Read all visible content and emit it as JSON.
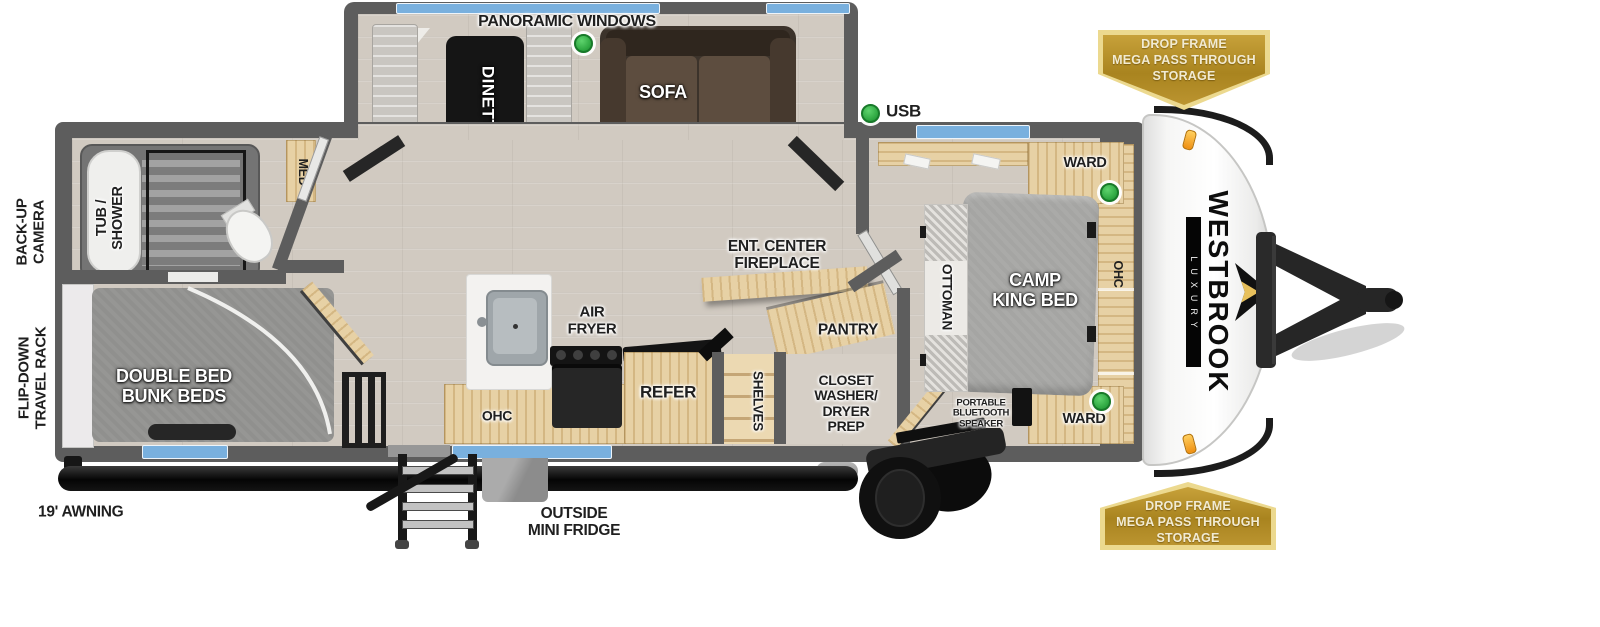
{
  "brand": {
    "name": "WESTBROOK",
    "tagline": "LUXURY"
  },
  "exterior": {
    "awning": "19' AWNING",
    "outside_fridge_line1": "OUTSIDE",
    "outside_fridge_line2": "MINI FRIDGE",
    "back_up_camera_line1": "BACK-UP",
    "back_up_camera_line2": "CAMERA",
    "travel_rack_line1": "FLIP-DOWN",
    "travel_rack_line2": "TRAVEL RACK",
    "badge_top": {
      "line1": "DROP FRAME",
      "line2": "MEGA PASS THROUGH",
      "line3": "STORAGE"
    },
    "badge_bottom": {
      "line1": "DROP FRAME",
      "line2": "MEGA PASS THROUGH",
      "line3": "STORAGE"
    }
  },
  "living_area": {
    "panoramic_windows": "PANORAMIC WINDOWS",
    "dinette": "DINETTE",
    "sofa": "SOFA",
    "usb": "USB",
    "ent_center_line1": "ENT. CENTER",
    "ent_center_line2": "FIREPLACE",
    "pantry": "PANTRY",
    "shelves": "SHELVES",
    "closet_line1": "CLOSET",
    "closet_line2": "WASHER/",
    "closet_line3": "DRYER",
    "closet_line4": "PREP"
  },
  "kitchen": {
    "air_fryer_line1": "AIR",
    "air_fryer_line2": "FRYER",
    "ohc": "OHC",
    "refer": "REFER"
  },
  "bathroom": {
    "tub_shower_line1": "TUB /",
    "tub_shower_line2": "SHOWER",
    "med": "MED"
  },
  "bunk_room": {
    "bed_line1": "DOUBLE BED",
    "bed_line2": "BUNK BEDS"
  },
  "bedroom": {
    "bed_line1": "CAMP",
    "bed_line2": "KING BED",
    "ottoman": "OTTOMAN",
    "ward_top": "WARD",
    "ward_bottom": "WARD",
    "ohc": "OHC",
    "speaker_line1": "PORTABLE",
    "speaker_line2": "BLUETOOTH",
    "speaker_line3": "SPEAKER"
  },
  "colors": {
    "badge_gold": "#b5912e",
    "badge_border": "#ecd98f",
    "badge_text": "#f2ebd2",
    "marker_green": "#3bb54a",
    "window_blue": "#79b0de",
    "wall_gray": "#5d5d5d",
    "wood_tan": "#e7d1a5",
    "floor": "#d1cac1"
  }
}
